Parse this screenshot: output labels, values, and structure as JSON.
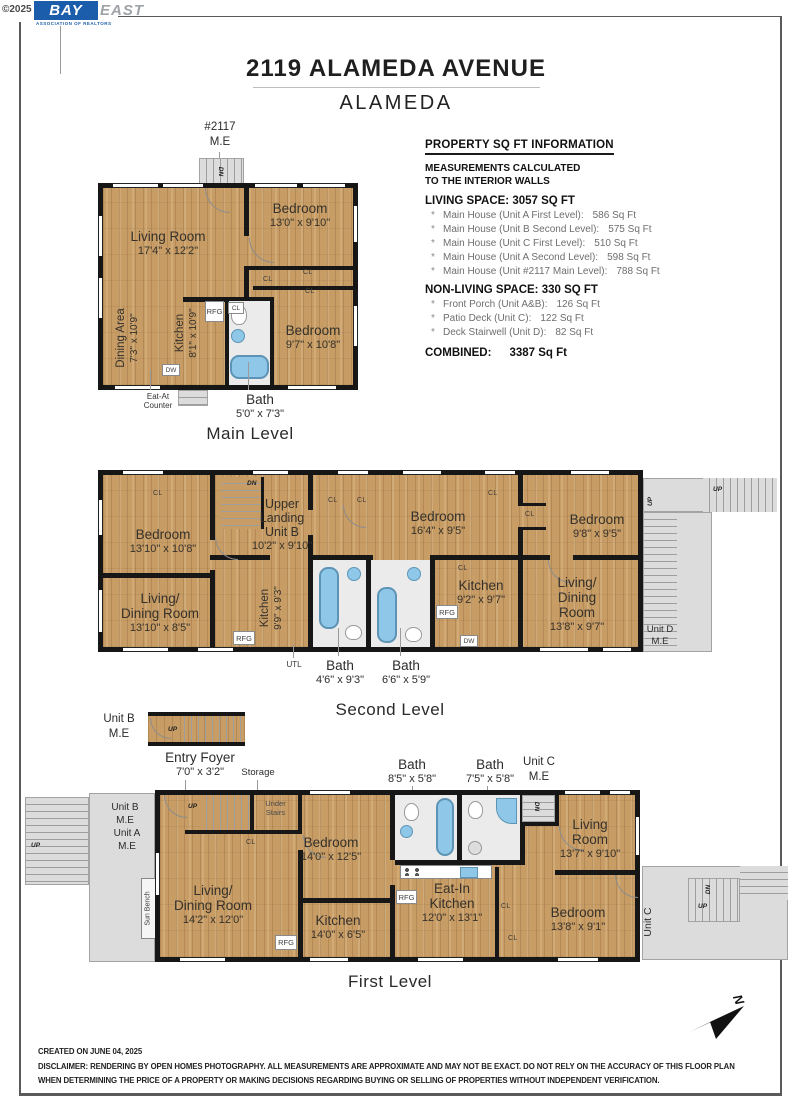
{
  "meta": {
    "copyright": "©2025",
    "logo_bay": "BAY",
    "logo_east": "EAST",
    "logo_sub": "ASSOCIATION OF REALTORS"
  },
  "header": {
    "title": "2119 ALAMEDA AVENUE",
    "subtitle": "ALAMEDA"
  },
  "info": {
    "heading": "PROPERTY SQ FT INFORMATION",
    "meas1": "MEASUREMENTS CALCULATED",
    "meas2": "TO THE INTERIOR WALLS",
    "living_heading": "LIVING SPACE: 3057 SQ FT",
    "bullet": "*",
    "living_items": [
      {
        "label": "Main House (Unit A First Level):",
        "value": "586 Sq Ft"
      },
      {
        "label": "Main House (Unit B Second Level):",
        "value": "575 Sq Ft"
      },
      {
        "label": "Main House (Unit C First Level):",
        "value": "510 Sq Ft"
      },
      {
        "label": "Main House (Unit A Second Level):",
        "value": "598 Sq Ft"
      },
      {
        "label": "Main House (Unit #2117 Main Level):",
        "value": "788 Sq Ft"
      }
    ],
    "nonliving_heading": "NON-LIVING SPACE: 330 SQ FT",
    "nonliving_items": [
      {
        "label": "Front Porch (Unit A&B):",
        "value": "126 Sq Ft"
      },
      {
        "label": "Patio Deck (Unit C):",
        "value": "122 Sq Ft"
      },
      {
        "label": "Deck Stairwell (Unit D):",
        "value": "82 Sq Ft"
      }
    ],
    "combined_label": "COMBINED:",
    "combined_value": "3387 Sq Ft"
  },
  "tags": {
    "cl": "CL",
    "rfg": "RFG",
    "dw": "DW",
    "dn": "DN",
    "up": "UP",
    "utl": "UTL"
  },
  "units": {
    "m2117": [
      "#2117",
      "M.E"
    ],
    "unit_b_me": [
      "Unit B",
      "M.E"
    ],
    "unit_a_me": [
      "Unit A",
      "M.E"
    ],
    "unit_c_me": [
      "Unit C",
      "M.E"
    ],
    "unit_d_me": [
      "Unit D",
      "M.E"
    ],
    "unit_c": "Unit C"
  },
  "annotations": {
    "eat_at": [
      "Eat-At",
      "Counter"
    ],
    "bath_main": [
      "Bath",
      "5'0\" x 7'3\""
    ],
    "bath_2a": [
      "Bath",
      "4'6\" x 9'3\""
    ],
    "bath_2b": [
      "Bath",
      "6'6\" x 5'9\""
    ],
    "bath_1a": [
      "Bath",
      "8'5\" x 5'8\""
    ],
    "bath_1b": [
      "Bath",
      "7'5\" x 5'8\""
    ],
    "entry_foyer": [
      "Entry Foyer",
      "7'0\" x 3'2\""
    ],
    "storage": "Storage",
    "under_stairs": [
      "Under",
      "Stairs"
    ],
    "sun_bench": "Sun Bench"
  },
  "levels": {
    "main": {
      "caption": "Main Level",
      "rooms": {
        "living": [
          "Living Room",
          "17'4\" x 12'2\""
        ],
        "bedroom1": [
          "Bedroom",
          "13'0\" x 9'10\""
        ],
        "bedroom2": [
          "Bedroom",
          "9'7\" x 10'8\""
        ],
        "dining": [
          "Dining Area",
          "7'3\" x 10'9\""
        ],
        "kitchen": [
          "Kitchen",
          "8'1\" x 10'9\""
        ]
      }
    },
    "second": {
      "caption": "Second Level",
      "rooms": {
        "bedroom1": [
          "Bedroom",
          "13'10\" x 10'8\""
        ],
        "landing": [
          "Upper",
          "Landing",
          "Unit B",
          "10'2\" x 9'10\""
        ],
        "bedroom2": [
          "Bedroom",
          "16'4\" x 9'5\""
        ],
        "bedroom3": [
          "Bedroom",
          "9'8\" x 9'5\""
        ],
        "livdin1": [
          "Living/",
          "Dining Room",
          "13'10\" x 8'5\""
        ],
        "kitchen1": [
          "Kitchen",
          "9'9\" x 9'3\""
        ],
        "kitchen2": [
          "Kitchen",
          "9'2\" x 9'7\""
        ],
        "livdin2": [
          "Living/",
          "Dining",
          "Room",
          "13'8\" x 9'7\""
        ]
      }
    },
    "first": {
      "caption": "First Level",
      "rooms": {
        "livdin": [
          "Living/",
          "Dining Room",
          "14'2\" x 12'0\""
        ],
        "bedroom1": [
          "Bedroom",
          "14'0\" x 12'5\""
        ],
        "kitchen": [
          "Kitchen",
          "14'0\" x 6'5\""
        ],
        "eatin": [
          "Eat-In",
          "Kitchen",
          "12'0\" x 13'1\""
        ],
        "living": [
          "Living",
          "Room",
          "13'7\" x 9'10\""
        ],
        "bedroom2": [
          "Bedroom",
          "13'8\" x 9'1\""
        ]
      }
    }
  },
  "compass": {
    "letter": "N"
  },
  "footer": {
    "created": "CREATED ON JUNE 04, 2025",
    "disclaimer1": "DISCLAIMER: RENDERING BY OPEN HOMES PHOTOGRAPHY. ALL MEASUREMENTS ARE APPROXIMATE AND MAY NOT BE EXACT. DO NOT RELY ON THE ACCURACY OF THIS FLOOR PLAN",
    "disclaimer2": "WHEN DETERMINING THE PRICE OF A PROPERTY OR MAKING DECISIONS REGARDING BUYING OR SELLING OF PROPERTIES WITHOUT INDEPENDENT VERIFICATION."
  }
}
